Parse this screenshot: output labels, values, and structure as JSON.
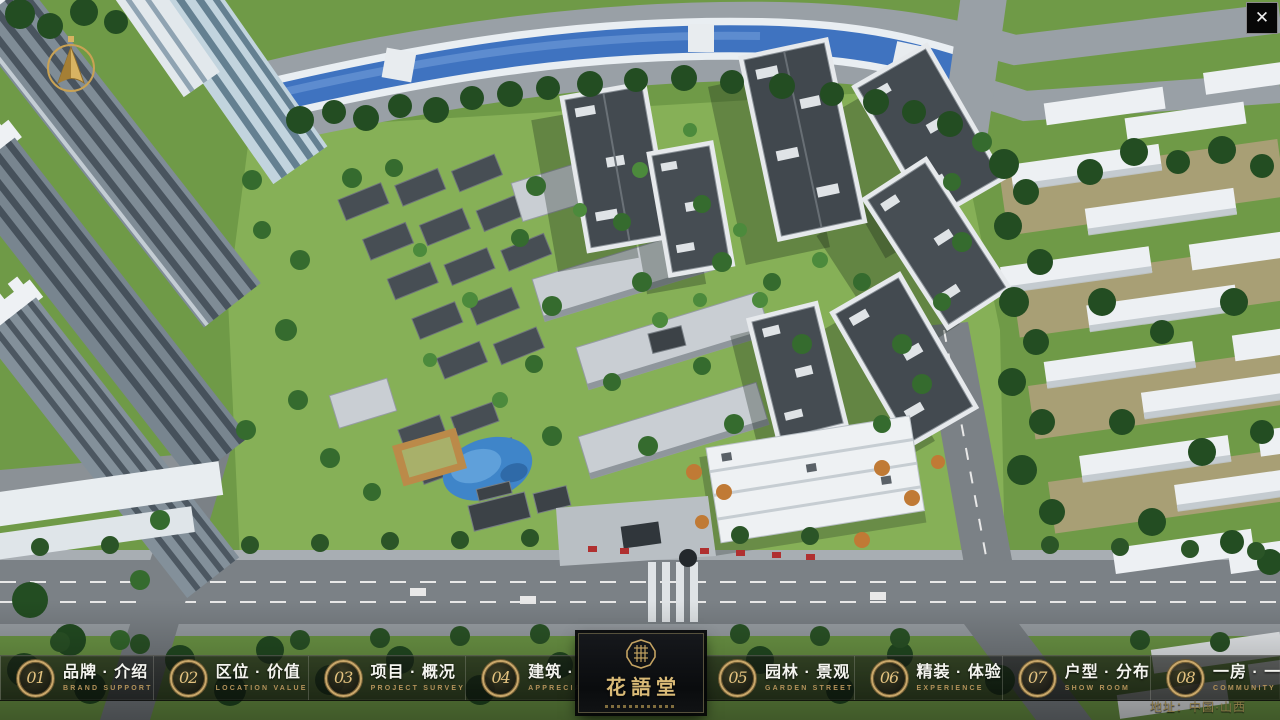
{
  "window": {
    "icons": {
      "close": "✕"
    }
  },
  "nav": {
    "items": [
      {
        "num": "01",
        "label": "品牌 · 介绍",
        "sub": "BRAND SUPPORT"
      },
      {
        "num": "02",
        "label": "区位 · 价值",
        "sub": "LOCATION VALUE"
      },
      {
        "num": "03",
        "label": "项目 · 概况",
        "sub": "PROJECT SURVEY"
      },
      {
        "num": "04",
        "label": "建筑 · 鉴赏",
        "sub": "APPRECIATION"
      },
      {
        "num": "05",
        "label": "园林 · 景观",
        "sub": "GARDEN STREET"
      },
      {
        "num": "06",
        "label": "精装 · 体验",
        "sub": "EXPERIENCE"
      },
      {
        "num": "07",
        "label": "户型 · 分布",
        "sub": "SHOW ROOM"
      },
      {
        "num": "08",
        "label": "一房 · 一景",
        "sub": "COMMUNITY"
      }
    ]
  },
  "logo": {
    "title": "花語堂"
  },
  "footer": {
    "address": "地址：中国·山西"
  },
  "colors": {
    "accent_gold": "#c9a76a",
    "gold_text": "#d9ba77",
    "nav_bg": "rgba(12,14,12,0.62)",
    "river_blue": "#3f73c0",
    "grass_green": "#84ae55"
  }
}
